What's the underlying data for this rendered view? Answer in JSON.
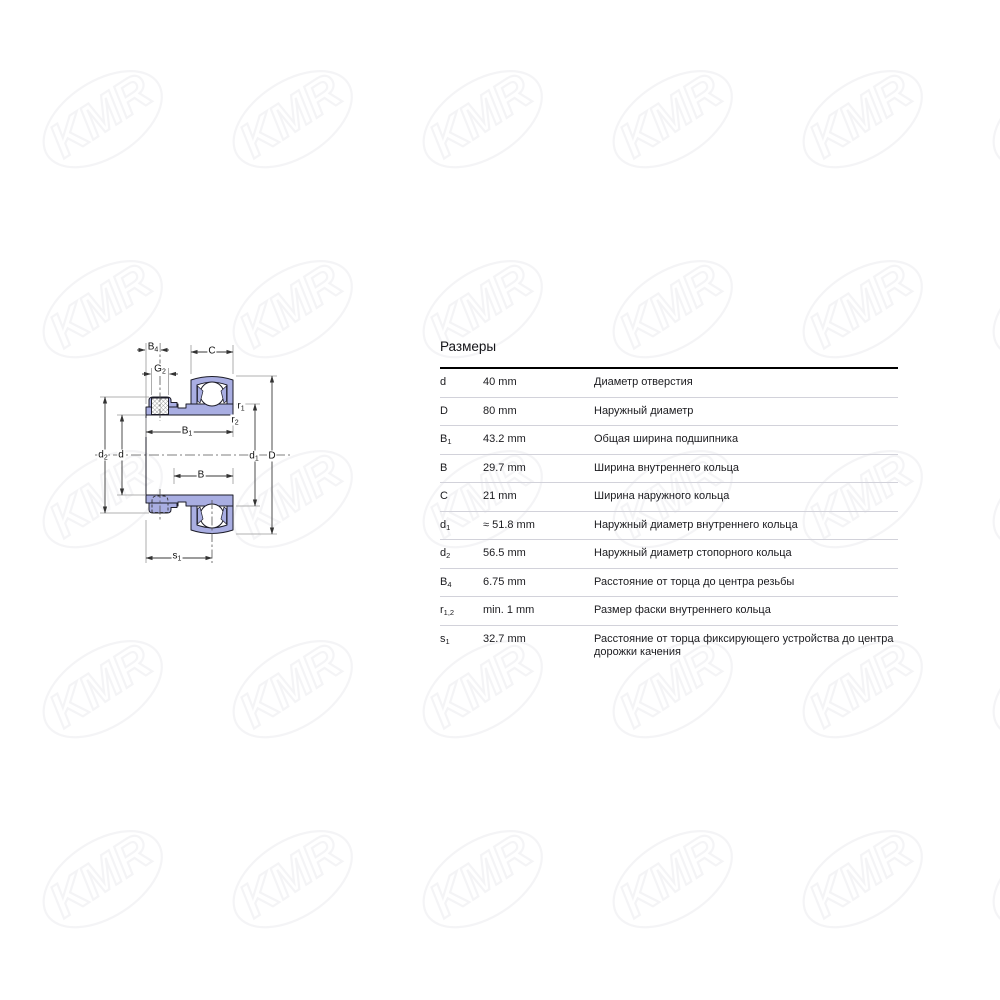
{
  "watermark": {
    "text": "KMR"
  },
  "diagram": {
    "labels": {
      "b4": {
        "base": "B",
        "sub": "4"
      },
      "g2": {
        "base": "G",
        "sub": "2"
      },
      "c": {
        "base": "C",
        "sub": ""
      },
      "d2": {
        "base": "d",
        "sub": "2"
      },
      "d": {
        "base": "d",
        "sub": ""
      },
      "b1": {
        "base": "B",
        "sub": "1"
      },
      "b": {
        "base": "B",
        "sub": ""
      },
      "r1": {
        "base": "r",
        "sub": "1"
      },
      "r2": {
        "base": "r",
        "sub": "2"
      },
      "d1": {
        "base": "d",
        "sub": "1"
      },
      "D": {
        "base": "D",
        "sub": ""
      },
      "s1": {
        "base": "s",
        "sub": "1"
      }
    }
  },
  "table": {
    "title": "Размеры",
    "rows": [
      {
        "sym": "d",
        "sub": "",
        "value": "40 mm",
        "desc": "Диаметр отверстия"
      },
      {
        "sym": "D",
        "sub": "",
        "value": "80 mm",
        "desc": "Наружный диаметр"
      },
      {
        "sym": "B",
        "sub": "1",
        "value": "43.2 mm",
        "desc": "Общая ширина подшипника"
      },
      {
        "sym": "B",
        "sub": "",
        "value": "29.7 mm",
        "desc": "Ширина внутреннего кольца"
      },
      {
        "sym": "C",
        "sub": "",
        "value": "21 mm",
        "desc": "Ширина наружного кольца"
      },
      {
        "sym": "d",
        "sub": "1",
        "value": "≈ 51.8 mm",
        "desc": "Наружный диаметр внутреннего кольца"
      },
      {
        "sym": "d",
        "sub": "2",
        "value": "56.5 mm",
        "desc": "Наружный диаметр стопорного кольца"
      },
      {
        "sym": "B",
        "sub": "4",
        "value": "6.75 mm",
        "desc": "Расстояние от торца до центра резьбы"
      },
      {
        "sym": "r",
        "sub": "1,2",
        "value": "min. 1 mm",
        "desc": "Размер фаски внутреннего кольца"
      },
      {
        "sym": "s",
        "sub": "1",
        "value": "32.7 mm",
        "desc": "Расстояние от торца фиксирующего устройства до центра дорожки качения"
      }
    ]
  }
}
